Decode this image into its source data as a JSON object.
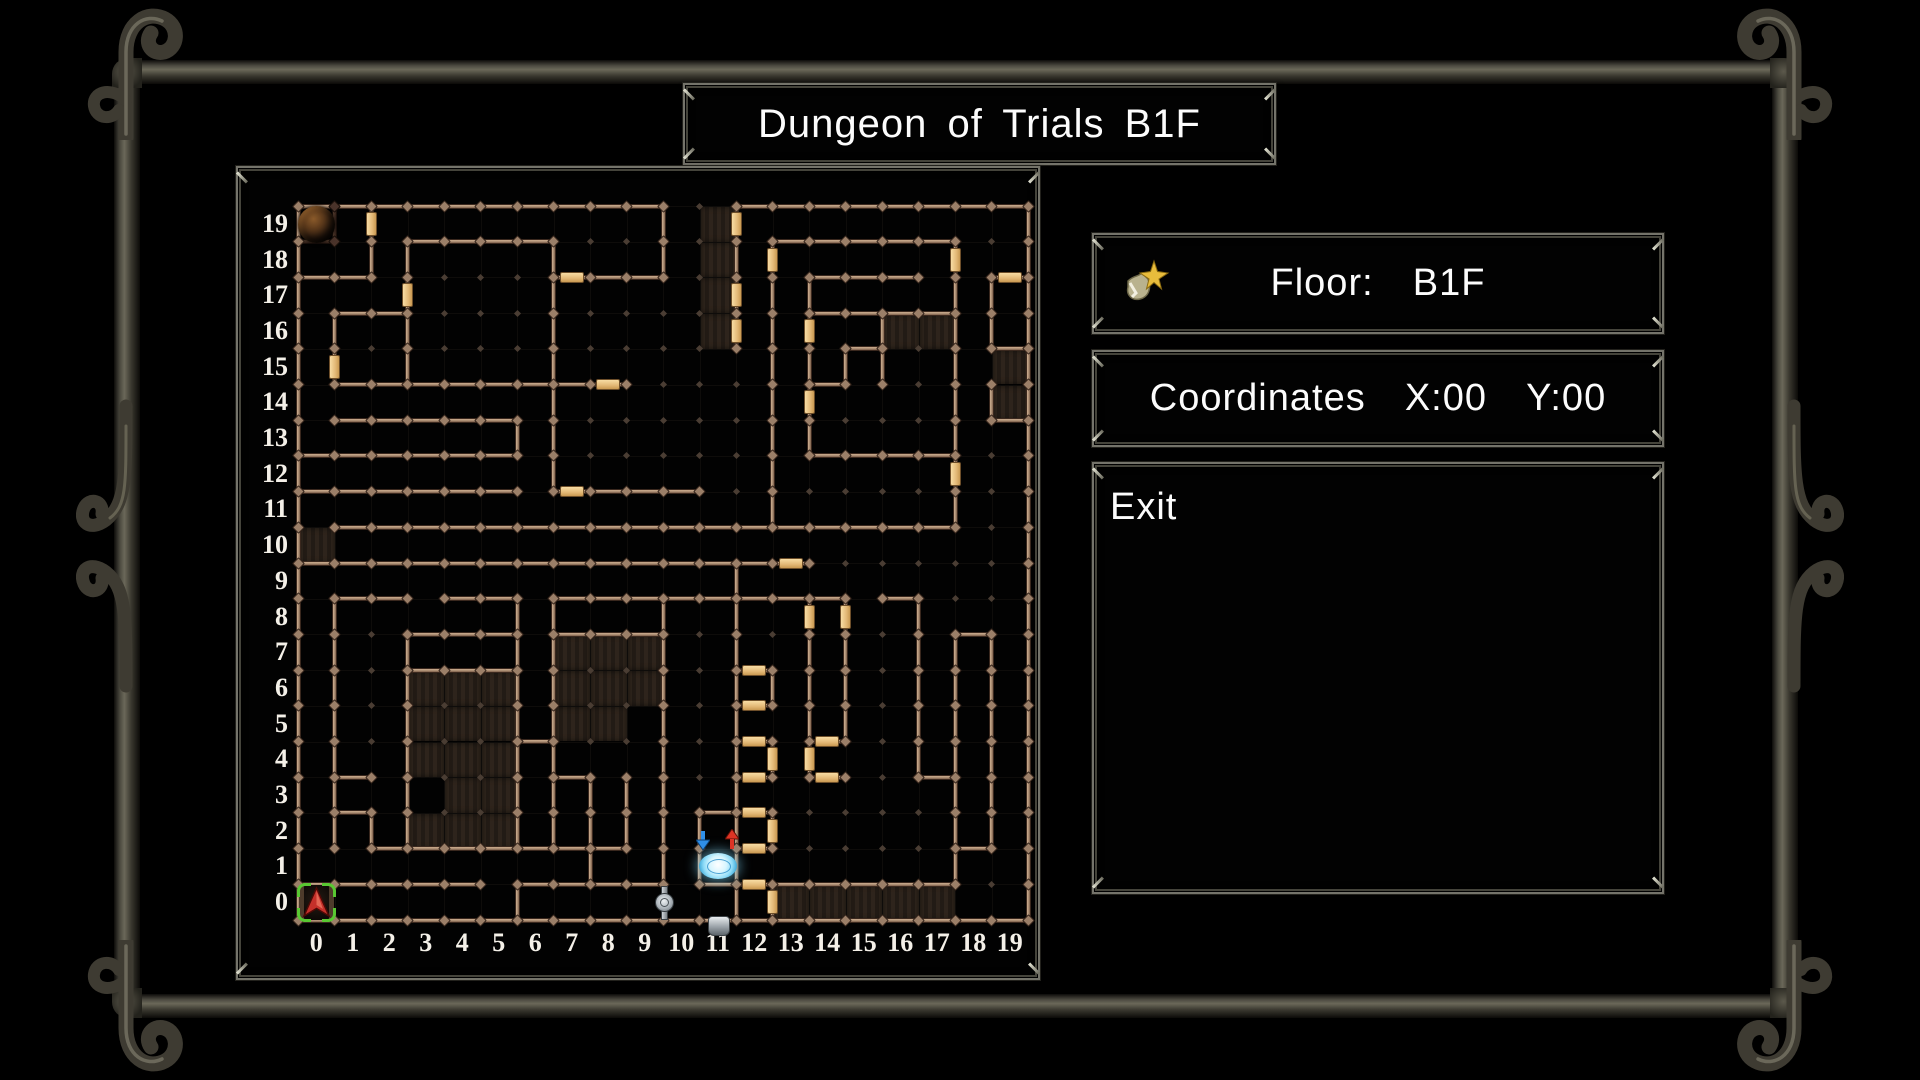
{
  "title": "Dungeon of Trials B1F",
  "floor_panel": {
    "label": "Floor:",
    "value": "B1F",
    "icon": "map-star-icon"
  },
  "coordinates_panel": {
    "label": "Coordinates",
    "x_text": "X:00",
    "y_text": "Y:00"
  },
  "menu": {
    "items": [
      "Exit"
    ]
  },
  "colors": {
    "wall": "#ab8d73",
    "door": "#e3b876",
    "dim_wall": "#4a3226",
    "dark_cell": "#2a211a",
    "grid_dot": "#4a3d33",
    "bracket_green": "#58c832",
    "player_arrow_red": "#c5302a",
    "portal_blue": "#8edcf8",
    "metal": "#74736a"
  },
  "map": {
    "cols": 20,
    "rows": 20,
    "x_labels": [
      "0",
      "1",
      "2",
      "3",
      "4",
      "5",
      "6",
      "7",
      "8",
      "9",
      "10",
      "11",
      "12",
      "13",
      "14",
      "15",
      "16",
      "17",
      "18",
      "19"
    ],
    "y_labels": [
      "0",
      "1",
      "2",
      "3",
      "4",
      "5",
      "6",
      "7",
      "8",
      "9",
      "10",
      "11",
      "12",
      "13",
      "14",
      "15",
      "16",
      "17",
      "18",
      "19"
    ],
    "h_walls": [
      [
        20,
        0,
        10
      ],
      [
        20,
        12,
        20
      ],
      [
        19,
        0,
        1,
        1
      ],
      [
        19,
        3,
        7
      ],
      [
        19,
        13,
        18
      ],
      [
        18,
        0,
        2
      ],
      [
        18,
        7,
        10
      ],
      [
        18,
        14,
        17
      ],
      [
        18,
        19,
        20
      ],
      [
        17,
        1,
        3
      ],
      [
        17,
        14,
        18
      ],
      [
        16,
        15,
        16
      ],
      [
        16,
        19,
        20
      ],
      [
        15,
        1,
        9
      ],
      [
        15,
        14,
        15
      ],
      [
        14,
        1,
        6
      ],
      [
        14,
        19,
        20
      ],
      [
        13,
        0,
        6
      ],
      [
        13,
        14,
        18
      ],
      [
        12,
        0,
        6
      ],
      [
        12,
        7,
        11
      ],
      [
        11,
        1,
        18
      ],
      [
        10,
        0,
        14
      ],
      [
        9,
        1,
        3
      ],
      [
        9,
        4,
        6
      ],
      [
        9,
        7,
        15
      ],
      [
        9,
        16,
        17
      ],
      [
        8,
        3,
        6
      ],
      [
        8,
        7,
        10
      ],
      [
        8,
        18,
        19
      ],
      [
        7,
        3,
        6
      ],
      [
        7,
        12,
        13
      ],
      [
        6,
        12,
        13
      ],
      [
        5,
        6,
        7
      ],
      [
        5,
        12,
        13
      ],
      [
        5,
        14,
        15
      ],
      [
        4,
        1,
        2
      ],
      [
        4,
        7,
        8
      ],
      [
        4,
        12,
        13
      ],
      [
        4,
        14,
        15
      ],
      [
        4,
        17,
        18
      ],
      [
        3,
        1,
        2
      ],
      [
        3,
        11,
        13
      ],
      [
        2,
        2,
        9
      ],
      [
        2,
        12,
        13
      ],
      [
        2,
        18,
        19
      ],
      [
        1,
        0,
        5
      ],
      [
        1,
        6,
        10
      ],
      [
        1,
        11,
        18
      ],
      [
        0,
        0,
        20
      ]
    ],
    "v_walls": [
      [
        0,
        0,
        20
      ],
      [
        1,
        2,
        9
      ],
      [
        1,
        15,
        17
      ],
      [
        1,
        19,
        20,
        1
      ],
      [
        2,
        2,
        3
      ],
      [
        2,
        18,
        20
      ],
      [
        3,
        2,
        8
      ],
      [
        3,
        15,
        19
      ],
      [
        6,
        0,
        1
      ],
      [
        6,
        2,
        9
      ],
      [
        6,
        13,
        14
      ],
      [
        7,
        2,
        9
      ],
      [
        7,
        12,
        19
      ],
      [
        8,
        1,
        4
      ],
      [
        9,
        2,
        4
      ],
      [
        10,
        1,
        9
      ],
      [
        10,
        18,
        20
      ],
      [
        11,
        1,
        3
      ],
      [
        12,
        0,
        10
      ],
      [
        12,
        16,
        20
      ],
      [
        13,
        0,
        1
      ],
      [
        13,
        2,
        3
      ],
      [
        13,
        4,
        5
      ],
      [
        13,
        6,
        7
      ],
      [
        13,
        11,
        19
      ],
      [
        14,
        4,
        9
      ],
      [
        14,
        13,
        18
      ],
      [
        15,
        5,
        9
      ],
      [
        15,
        15,
        16
      ],
      [
        16,
        15,
        17
      ],
      [
        17,
        4,
        9
      ],
      [
        18,
        1,
        8
      ],
      [
        18,
        11,
        19
      ],
      [
        19,
        2,
        8
      ],
      [
        19,
        14,
        15
      ],
      [
        19,
        16,
        18
      ],
      [
        20,
        0,
        20
      ]
    ],
    "doors_h": [
      [
        18,
        7
      ],
      [
        18,
        19
      ],
      [
        15,
        8
      ],
      [
        12,
        7
      ],
      [
        10,
        13
      ],
      [
        7,
        12
      ],
      [
        6,
        12
      ],
      [
        5,
        12
      ],
      [
        5,
        14
      ],
      [
        4,
        12
      ],
      [
        4,
        14
      ],
      [
        3,
        12
      ],
      [
        2,
        12
      ],
      [
        1,
        12
      ]
    ],
    "doors_v": [
      [
        1,
        15
      ],
      [
        2,
        19
      ],
      [
        3,
        17
      ],
      [
        12,
        16
      ],
      [
        12,
        17
      ],
      [
        12,
        19
      ],
      [
        13,
        0
      ],
      [
        13,
        2
      ],
      [
        13,
        4
      ],
      [
        13,
        18
      ],
      [
        14,
        4
      ],
      [
        14,
        8
      ],
      [
        14,
        14
      ],
      [
        14,
        16
      ],
      [
        15,
        8
      ],
      [
        18,
        12
      ],
      [
        18,
        18
      ]
    ],
    "dark_cells": [
      [
        0,
        10
      ],
      [
        11,
        16
      ],
      [
        11,
        17
      ],
      [
        11,
        18
      ],
      [
        11,
        19
      ],
      [
        16,
        16
      ],
      [
        17,
        16
      ],
      [
        19,
        14
      ],
      [
        19,
        15
      ],
      [
        3,
        2
      ],
      [
        3,
        4
      ],
      [
        3,
        5
      ],
      [
        3,
        6
      ],
      [
        4,
        2
      ],
      [
        4,
        3
      ],
      [
        4,
        4
      ],
      [
        4,
        5
      ],
      [
        4,
        6
      ],
      [
        5,
        2
      ],
      [
        5,
        3
      ],
      [
        5,
        4
      ],
      [
        5,
        5
      ],
      [
        5,
        6
      ],
      [
        7,
        5
      ],
      [
        7,
        6
      ],
      [
        7,
        7
      ],
      [
        8,
        5
      ],
      [
        8,
        6
      ],
      [
        8,
        7
      ],
      [
        9,
        6
      ],
      [
        9,
        7
      ],
      [
        13,
        0
      ],
      [
        14,
        0
      ],
      [
        15,
        0
      ],
      [
        16,
        0
      ],
      [
        17,
        0
      ]
    ],
    "icons": [
      {
        "name": "player-position-marker",
        "cell": [
          0,
          0
        ]
      },
      {
        "name": "monster-encounter-icon",
        "cell": [
          0,
          19
        ]
      },
      {
        "name": "portal-icon",
        "cell": [
          11,
          1
        ]
      },
      {
        "name": "chalice-icon",
        "cell": [
          11,
          0
        ]
      },
      {
        "name": "fountain-switch-icon",
        "cell": [
          9.9,
          0
        ]
      }
    ]
  }
}
